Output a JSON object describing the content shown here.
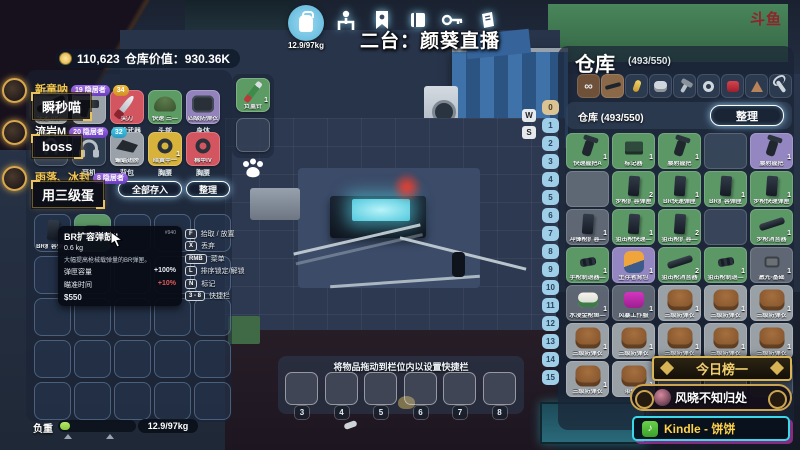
{
  "hud": {
    "money": "110,623",
    "warehouse_value": "仓库价值：930.36K",
    "carry_weight": "12.9/97kg",
    "stream_title": "二台：颜葵直播",
    "platform_watermark": "斗鱼"
  },
  "toolbar": {
    "icons": [
      "backpack",
      "character",
      "badge",
      "book",
      "key",
      "journal"
    ]
  },
  "chat": {
    "messages": [
      {
        "name": "新童呐",
        "name_color": "#f5c952",
        "badges": [
          {
            "text": "19 隐居者",
            "type": "purple"
          },
          {
            "text": "34",
            "type": "yellow"
          }
        ],
        "message": "瞬秒喵"
      },
      {
        "name": "流岩M",
        "name_color": "#ffffff",
        "badges": [
          {
            "text": "20 隐居者",
            "type": "purple"
          },
          {
            "text": "32",
            "type": "cyan"
          }
        ],
        "message": "boss"
      },
      {
        "name": "雨落、冰封",
        "name_color": "#f5c952",
        "badges": [
          {
            "text": "8 隐居者",
            "type": "purple"
          }
        ],
        "message": "用三级蛋"
      }
    ]
  },
  "equipment": {
    "rows": [
      [
        {
          "slot_label": "",
          "item_label": "快递 AK—",
          "bg": "gray",
          "icon": "rifle"
        },
        {
          "slot_label": "",
          "item_label": "",
          "bg": "gray",
          "icon": "pistol"
        },
        {
          "slot_label": "近战武器",
          "item_label": "尖刀",
          "bg": "red",
          "icon": "knife"
        },
        {
          "slot_label": "头部",
          "item_label": "快速 三—",
          "bg": "green",
          "icon": "helmet"
        },
        {
          "slot_label": "身体",
          "item_label": "四级防弹衣",
          "bg": "purple",
          "icon": "bodyarmor"
        }
      ],
      [
        {
          "slot_label": "",
          "item_label": "",
          "bg": "dark",
          "icon": "hook"
        },
        {
          "slot_label": "耳机",
          "item_label": "",
          "bg": "dark",
          "icon": "headset"
        },
        {
          "slot_label": "背包",
          "item_label": "蝙蝠翅膀",
          "bg": "gray",
          "icon": "packdark"
        },
        {
          "slot_label": "胸腰",
          "item_label": "暗黄甲一",
          "bg": "yellow",
          "icon": "amulet",
          "count": "1"
        },
        {
          "slot_label": "胸腰",
          "item_label": "棉甲IV",
          "bg": "red",
          "icon": "amulet"
        }
      ]
    ],
    "store_all_label": "全部存入",
    "sort_label": "整理",
    "pocket_item": {
      "name": "负重针",
      "count": "1"
    }
  },
  "inventory": {
    "first_item_label": "BR扩容弹—"
  },
  "tooltip": {
    "title": "BR扩容弹鼓II",
    "id": "#940",
    "weight": "0.6 kg",
    "desc": "大幅提高枪械载弹量的BR弹匣。",
    "stats": [
      {
        "label": "弹匣容量",
        "value": "+100%",
        "color": "#e8edf2"
      },
      {
        "label": "瞄准时间",
        "value": "+10%",
        "color": "#e05a5a"
      }
    ],
    "price": "$550"
  },
  "keybinds": [
    {
      "key": "F",
      "label": "拾取 / 放置"
    },
    {
      "key": "X",
      "label": "丢弃"
    },
    {
      "key": "RMB",
      "label": "菜单"
    },
    {
      "key": "L",
      "label": "排序锁定/解锁"
    },
    {
      "key": "N",
      "label": "标记"
    },
    {
      "key": "3 - 8",
      "label": "快捷栏"
    }
  ],
  "warehouse": {
    "title": "仓库",
    "count": "(493/550)",
    "subtitle": "仓库 (493/550)",
    "sort_label": "整理",
    "tabs": [
      "all",
      "rifle",
      "ammo",
      "vest",
      "hammer",
      "ring",
      "meat",
      "cake",
      "wrench"
    ],
    "selected_tab": 1,
    "row_numbers": [
      "0",
      "1",
      "2",
      "3",
      "4",
      "5",
      "6",
      "7",
      "8",
      "9",
      "10",
      "11",
      "12",
      "13",
      "14",
      "15"
    ],
    "scroll_keys": [
      "W",
      "S"
    ],
    "grid": [
      [
        {
          "name": "快速握把A",
          "count": "1",
          "bg": "green",
          "icon": "grip"
        },
        {
          "name": "标记器",
          "count": "1",
          "bg": "green",
          "icon": "marker"
        },
        {
          "name": "腰射握把",
          "count": "1",
          "bg": "green",
          "icon": "grip"
        },
        {
          "bg": "empty"
        },
        {
          "name": "腰射握把",
          "count": "1",
          "bg": "purple",
          "icon": "grip"
        }
      ],
      [
        {
          "bg": "grayempty"
        },
        {
          "name": "步枪扩容弹匣",
          "count": "2",
          "bg": "green",
          "icon": "mag"
        },
        {
          "name": "BR快速弹匣",
          "count": "1",
          "bg": "green",
          "icon": "mag"
        },
        {
          "name": "BR扩容弹匣",
          "count": "1",
          "bg": "green",
          "icon": "mag"
        },
        {
          "name": "步枪快速弹匣",
          "count": "1",
          "bg": "green",
          "icon": "mag"
        }
      ],
      [
        {
          "name": "冲锋枪扩容—",
          "count": "1",
          "bg": "grayempty",
          "icon": "mag"
        },
        {
          "name": "狙击枪快速—",
          "count": "1",
          "bg": "green",
          "icon": "mag"
        },
        {
          "name": "狙击枪扩容—",
          "count": "2",
          "bg": "green",
          "icon": "mag"
        },
        {
          "bg": "empty"
        },
        {
          "name": "步枪消音器",
          "count": "1",
          "bg": "green",
          "icon": "rod"
        }
      ],
      [
        {
          "name": "手枪制退器—",
          "count": "1",
          "bg": "green",
          "icon": "muzzle"
        },
        {
          "name": "生存者背包",
          "count": "1",
          "bg": "purple",
          "icon": "pack"
        },
        {
          "name": "狙击枪消音器",
          "count": "2",
          "bg": "green",
          "icon": "rod"
        },
        {
          "name": "狙击枪制退—",
          "count": "1",
          "bg": "green",
          "icon": "muzzle"
        },
        {
          "name": "激光-基础",
          "count": "1",
          "bg": "grayempty",
          "icon": "laser"
        }
      ],
      [
        {
          "name": "水浸金枪鱼—",
          "count": "1",
          "bg": "grayempty",
          "icon": "can"
        },
        {
          "name": "风暴工作服",
          "count": "1",
          "bg": "grayempty",
          "icon": "suit"
        },
        {
          "name": "三级防弹衣",
          "count": "1",
          "bg": "gray",
          "icon": "vest"
        },
        {
          "name": "三级防弹衣",
          "count": "1",
          "bg": "gray",
          "icon": "vest"
        },
        {
          "name": "三级防弹衣",
          "count": "1",
          "bg": "gray",
          "icon": "vest"
        }
      ],
      [
        {
          "name": "三级防弹衣",
          "count": "1",
          "bg": "gray",
          "icon": "vest"
        },
        {
          "name": "三级防弹衣",
          "count": "1",
          "bg": "gray",
          "icon": "vest"
        },
        {
          "name": "三级防弹衣",
          "count": "1",
          "bg": "gray",
          "icon": "vest"
        },
        {
          "name": "三级防弹衣",
          "count": "1",
          "bg": "gray",
          "icon": "vest"
        },
        {
          "name": "三级防弹衣",
          "count": "1",
          "bg": "gray",
          "icon": "vest"
        }
      ],
      [
        {
          "name": "三级防弹衣",
          "count": "1",
          "bg": "gray",
          "icon": "vest"
        },
        {
          "name": "带火—",
          "count": "1",
          "bg": "gray",
          "icon": "vest"
        },
        {
          "bg": "empty"
        },
        {
          "bg": "empty"
        },
        {
          "bg": "empty"
        }
      ]
    ]
  },
  "hotbar": {
    "hint": "将物品拖动到栏位内以设置快捷栏",
    "slots": [
      "3",
      "4",
      "5",
      "6",
      "7",
      "8"
    ]
  },
  "weight": {
    "label": "负重",
    "value": "12.9/97kg",
    "percent": 13
  },
  "banners": {
    "daily_top_label": "今日榜一",
    "daily_top_user": "风晓不知归处",
    "subscriber": "Kindle - 饼饼"
  }
}
